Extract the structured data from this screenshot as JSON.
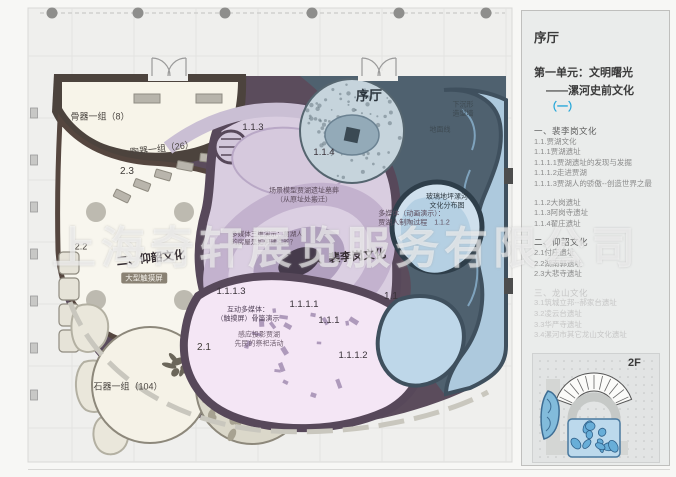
{
  "watermark": "上海奇轩展览服务有限公司",
  "sidebar": {
    "hall": "序厅",
    "unit_line1": "第一单元：文明曙光",
    "unit_line2_prefix": "——漯河史前文化",
    "unit_line2_highlight": "（一）",
    "floor_tag": "2F",
    "outline": [
      {
        "text": "一、裴李岗文化",
        "head": true
      },
      {
        "text": "1.1.贾湖文化"
      },
      {
        "text": "1.1.1贾湖遗址"
      },
      {
        "text": "1.1.1.1贾湖遗址的发现与发掘"
      },
      {
        "text": "1.1.1.2走进贾湖"
      },
      {
        "text": "1.1.1.3贾湖人的骄傲--创造世界之最"
      },
      {
        "text": "1.1.2大岗遗址",
        "gap": true
      },
      {
        "text": "1.1.3阿岗寺遗址"
      },
      {
        "text": "1.1.4翟庄遗址"
      },
      {
        "text": "二、仰韶文化",
        "head": true,
        "gap": true
      },
      {
        "text": "2.1付庄遗址"
      },
      {
        "text": "2.2湖南郭遗址"
      },
      {
        "text": "2.3大悲寺遗址"
      },
      {
        "text": "三、龙山文化",
        "head": true,
        "gap": true,
        "muted": true
      },
      {
        "text": "3.1筑城立邦--郝家台遗址",
        "muted": true
      },
      {
        "text": "3.2凌云台遗址",
        "muted": true
      },
      {
        "text": "3.3华严寺遗址",
        "muted": true
      },
      {
        "text": "3.4漯河市其它龙山文化遗址",
        "muted": true
      }
    ]
  },
  "plan": {
    "labels": [
      {
        "text": "骨器一组（8）",
        "x": 100,
        "y": 117,
        "size": 9,
        "color": "#4a4540"
      },
      {
        "text": "陶器一组（26）",
        "x": 162,
        "y": 149,
        "size": 9,
        "color": "#4a4540",
        "rot": -7
      },
      {
        "text": "2.3",
        "x": 127,
        "y": 172,
        "size": 10,
        "color": "#3f3b37"
      },
      {
        "text": "2.2",
        "x": 81,
        "y": 247,
        "size": 9,
        "color": "#3f3b37"
      },
      {
        "text": "二、仰韶文化",
        "x": 151,
        "y": 259,
        "size": 11.5,
        "color": "#332b30",
        "bold": true,
        "rot": -6
      },
      {
        "text": "大型触摸屏",
        "x": 144,
        "y": 278,
        "size": 7.5,
        "color": "#f2efe8",
        "chip": true
      },
      {
        "text": "石器一组（104）",
        "x": 128,
        "y": 387,
        "size": 9,
        "color": "#4a4540"
      },
      {
        "text": "2.1",
        "x": 204,
        "y": 348,
        "size": 10,
        "color": "#3f3b37"
      },
      {
        "text": "1.1.3",
        "x": 253,
        "y": 128,
        "size": 9.5,
        "color": "#3a333a"
      },
      {
        "text": "1.1.4",
        "x": 324,
        "y": 153,
        "size": 9.5,
        "color": "#3a333a"
      },
      {
        "text": "场景模型贾湖遗址墓葬\n（从原址处搬迁）",
        "x": 304,
        "y": 196,
        "size": 7,
        "color": "#5d4d5d"
      },
      {
        "text": "多媒体（动画演示）：\n贾湖人制陶过程　1.1.2",
        "x": 414,
        "y": 219,
        "size": 7,
        "color": "#5d4d5d",
        "align": "left"
      },
      {
        "text": "多媒体三维演示：贾湖人\n的房屋是如何建造的？",
        "x": 267,
        "y": 239,
        "size": 6.5,
        "color": "#5d4d5d",
        "align": "left"
      },
      {
        "text": "一、裴李岗文化",
        "x": 346,
        "y": 258,
        "size": 11.5,
        "color": "#332b30",
        "bold": true,
        "rot": -5
      },
      {
        "text": "1.1.1.3",
        "x": 231,
        "y": 292,
        "size": 9.5,
        "color": "#3a333a"
      },
      {
        "text": "互动多媒体：\n（触摸屏）骨笛演示",
        "x": 248,
        "y": 315,
        "size": 7,
        "color": "#53445a"
      },
      {
        "text": "1.1.1.1",
        "x": 304,
        "y": 305,
        "size": 9.5,
        "color": "#3a333a"
      },
      {
        "text": "1.1.1",
        "x": 329,
        "y": 321,
        "size": 9.5,
        "color": "#3a333a"
      },
      {
        "text": "感应投影贾湖\n先民的祭祀活动",
        "x": 259,
        "y": 340,
        "size": 7,
        "color": "#6d5d6d"
      },
      {
        "text": "1.1.1.2",
        "x": 353,
        "y": 356,
        "size": 9.5,
        "color": "#3a333a"
      },
      {
        "text": "1.1",
        "x": 391,
        "y": 297,
        "size": 10,
        "color": "#3a333a"
      },
      {
        "text": "序厅",
        "x": 369,
        "y": 96,
        "size": 13,
        "color": "#2b343c",
        "bold": true
      },
      {
        "text": "下沉形\n造型墙",
        "x": 463,
        "y": 110,
        "size": 7,
        "color": "#3e4a52"
      },
      {
        "text": "地面线",
        "x": 440,
        "y": 131,
        "size": 7,
        "color": "#3e4a52"
      },
      {
        "text": "玻璃地坪漯河\n文化分布图",
        "x": 447,
        "y": 202,
        "size": 7,
        "color": "#2f3a42"
      }
    ]
  }
}
